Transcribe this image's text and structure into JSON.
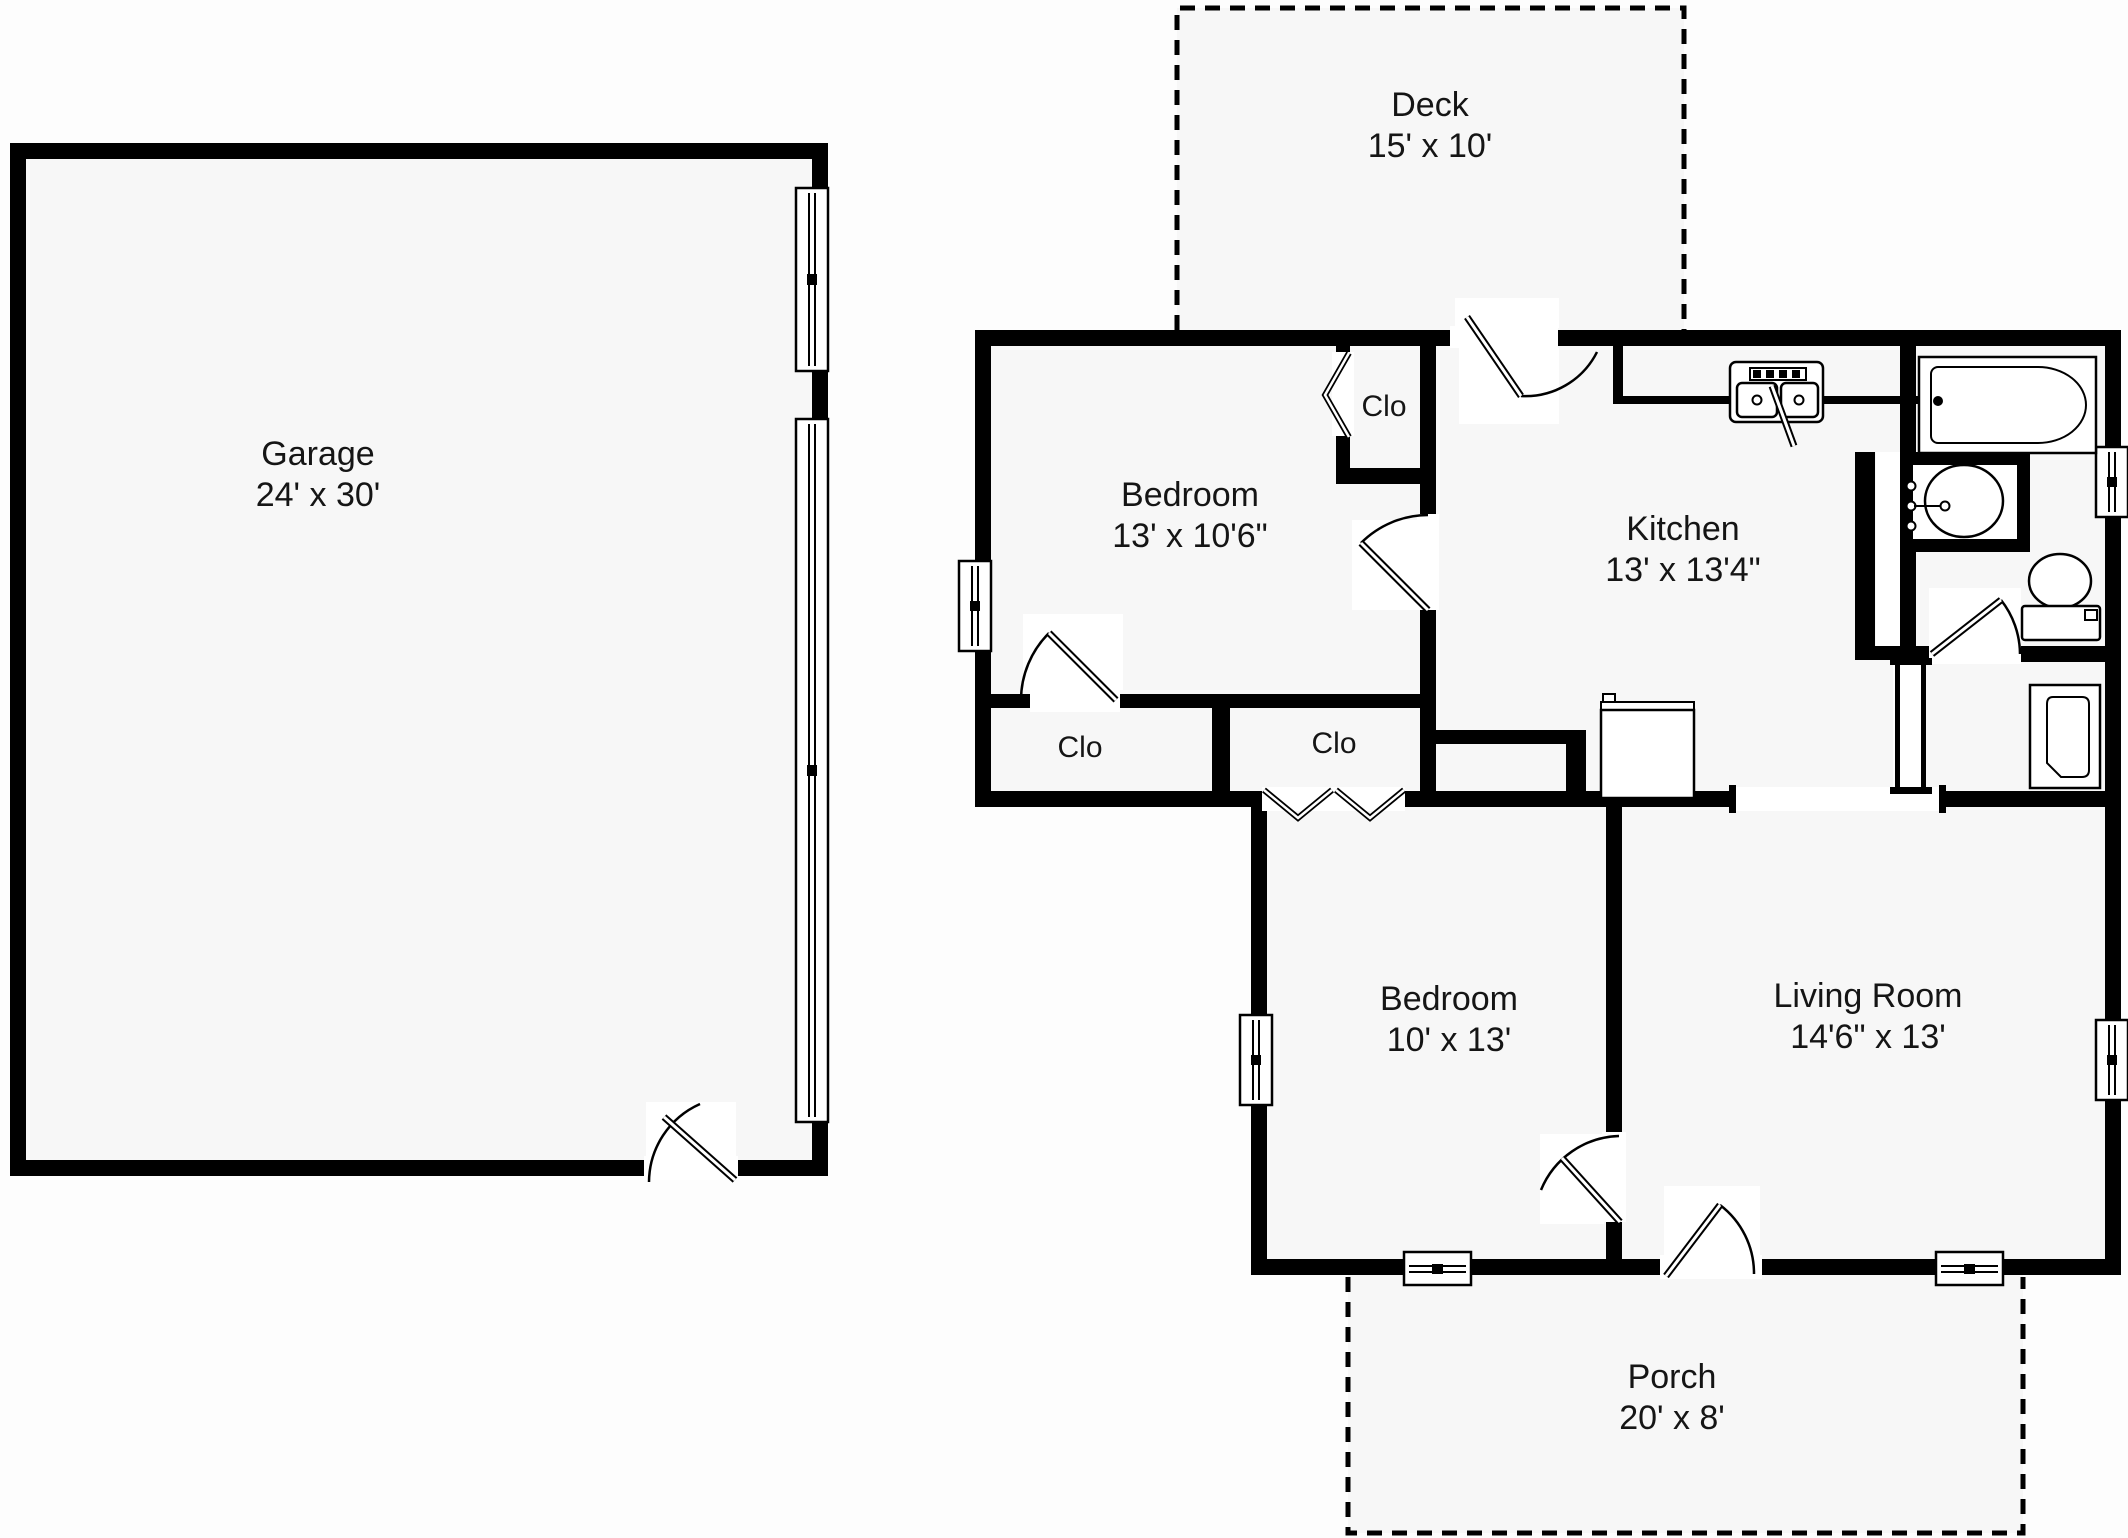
{
  "document": {
    "type": "floor-plan"
  },
  "rooms": {
    "garage": {
      "name": "Garage",
      "dims": "24' x 30'"
    },
    "deck": {
      "name": "Deck",
      "dims": "15' x 10'"
    },
    "bedroom1": {
      "name": "Bedroom",
      "dims": "13' x 10'6\""
    },
    "kitchen": {
      "name": "Kitchen",
      "dims": "13' x 13'4\""
    },
    "closet_bedroom1": {
      "name": "Clo"
    },
    "closet_hall_left": {
      "name": "Clo"
    },
    "closet_hall_right": {
      "name": "Clo"
    },
    "bedroom2": {
      "name": "Bedroom",
      "dims": "10' x 13'"
    },
    "living_room": {
      "name": "Living Room",
      "dims": "14'6\" x 13'"
    },
    "porch": {
      "name": "Porch",
      "dims": "20' x 8'"
    }
  },
  "colors": {
    "wall": "#000000",
    "room_fill": "#f7f7f7",
    "background": "#fdfdfd",
    "text": "#151515"
  }
}
